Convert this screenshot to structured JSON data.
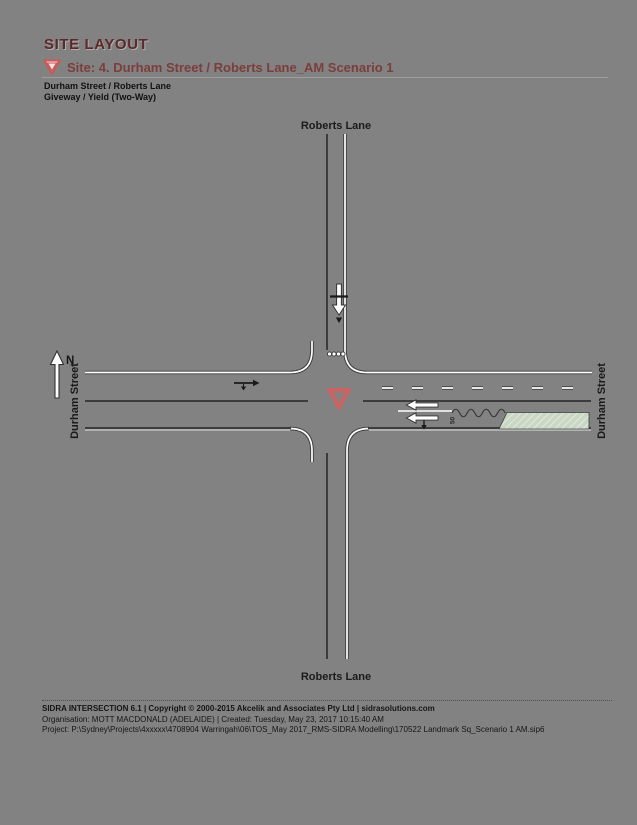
{
  "header": {
    "title": "SITE LAYOUT",
    "site_line": "Site: 4. Durham Street / Roberts Lane_AM Scenario 1",
    "subtitle1": "Durham Street / Roberts Lane",
    "subtitle2": "Giveway / Yield (Two-Way)"
  },
  "diagram": {
    "north_label": "N",
    "road_labels": {
      "north": "Roberts Lane",
      "south": "Roberts Lane",
      "west": "Durham Street",
      "east": "Durham Street"
    },
    "short_lane_label": "50",
    "colors": {
      "background": "#828282",
      "giveway_triangle": "#e05a5a",
      "short_lane_fill": "#c9d7c4",
      "title_color": "#5c2828",
      "site_line_color": "#7c3d3d"
    }
  },
  "footer": {
    "line1": "SIDRA INTERSECTION 6.1 | Copyright © 2000-2015 Akcelik and Associates Pty Ltd | sidrasolutions.com",
    "line2": "Organisation: MOTT MACDONALD (ADELAIDE) | Created: Tuesday, May 23, 2017 10:15:40 AM",
    "line3": "Project: P:\\Sydney\\Projects\\4xxxxx\\4708904 Warringah\\06\\TOS_May 2017_RMS-SIDRA Modelling\\170522 Landmark Sq_Scenario 1 AM.sip6"
  }
}
